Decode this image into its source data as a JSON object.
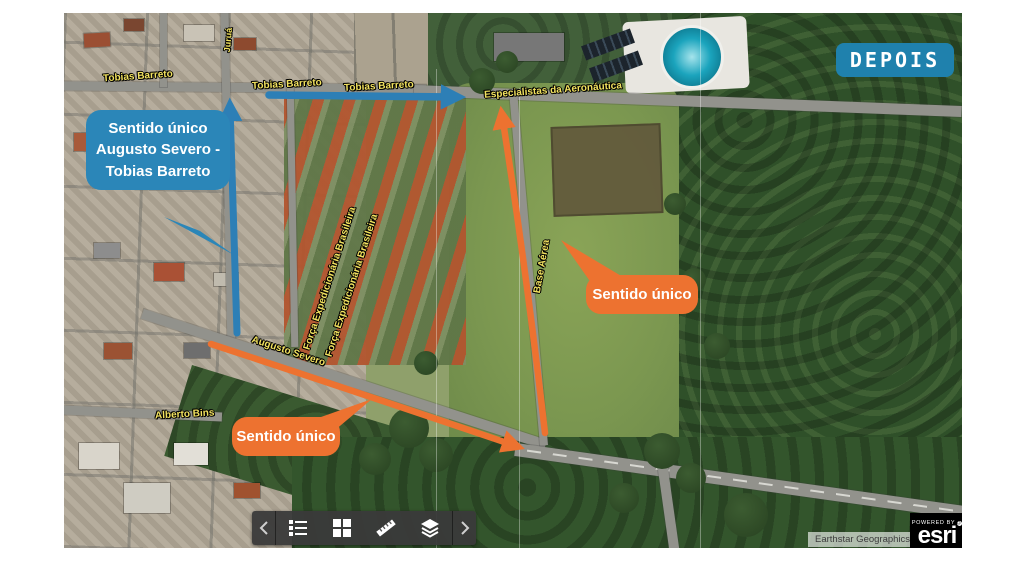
{
  "badge": {
    "label": "DEPOIS"
  },
  "callouts": {
    "blue": "Sentido único Augusto Severo - Tobias Barreto",
    "orange_right": "Sentido único",
    "orange_bottom": "Sentido único"
  },
  "streets": {
    "tobias_1": "Tobias Barreto",
    "tobias_2": "Tobias Barreto",
    "tobias_3": "Tobias Barreto",
    "especialistas": "Especialistas da Aeronáutica",
    "augusto": "Augusto Severo",
    "alberto": "Alberto Bins",
    "base_aerea": "Base Aérea",
    "feb_1": "Força Expedicionária Brasileira",
    "feb_2": "Força Expedicionária Brasileira",
    "cross_street": "Juruá"
  },
  "colors": {
    "callout_blue": "#2b86b8",
    "badge_blue": "#1f81ad",
    "arrow_blue": "#2d7fb6",
    "arrow_orange": "#ed7230",
    "street_label_yellow": "#f2e25f"
  },
  "toolbar": {
    "buttons": [
      "collapse-left",
      "legend",
      "basemap-grid",
      "measure",
      "layers",
      "expand-right"
    ]
  },
  "attribution": {
    "basemap_credit": "Earthstar Geographics",
    "powered_by": "POWERED BY",
    "brand": "esri"
  }
}
